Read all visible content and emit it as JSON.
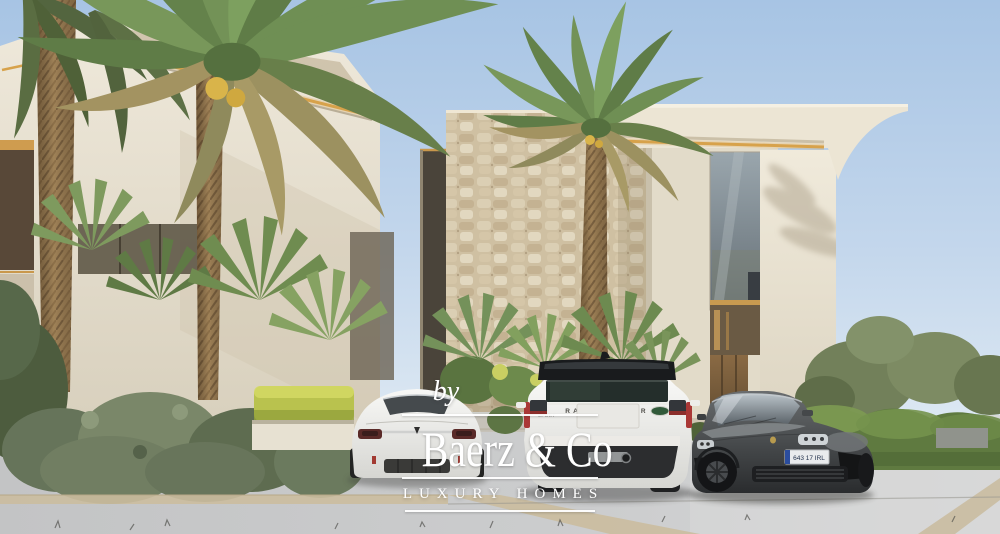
{
  "watermark": {
    "prefix": "by",
    "brand": "Baerz & Co",
    "tagline": "LUXURY HOMES"
  },
  "vehicles": {
    "tesla": {
      "color": "#f3f3f1",
      "logo_icon": "tesla-logo"
    },
    "range_rover": {
      "tailgate_text": "RANGE ROVER",
      "sport_badge": "SPORT",
      "badge_icon": "land-rover-oval-badge",
      "badge_color": "#315a3a",
      "body_color": "#f1f1ef",
      "roof_color": "#191b1d"
    },
    "porsche": {
      "license_plate": "643 17 IRL",
      "plate_band_color": "#2b4d9e",
      "crest_icon": "porsche-crest",
      "body_color": "#4e5154"
    }
  },
  "palette": {
    "sky_blue": "#aecbe8",
    "building_cream": "#e9e2d1",
    "gold_led_accent": "#d7a24b",
    "stone_tan": "#cfc0a2",
    "palm_green": "#6f8c52",
    "dried_frond_tan": "#a89a66",
    "hedge_green": "#5f7a40",
    "hedge_yellow": "#bfc654",
    "pavement_gray": "#c9cacb",
    "curb_tan": "#cbbd9f",
    "watermark_white": "#ffffff",
    "taillight_red": "#aa3836"
  }
}
